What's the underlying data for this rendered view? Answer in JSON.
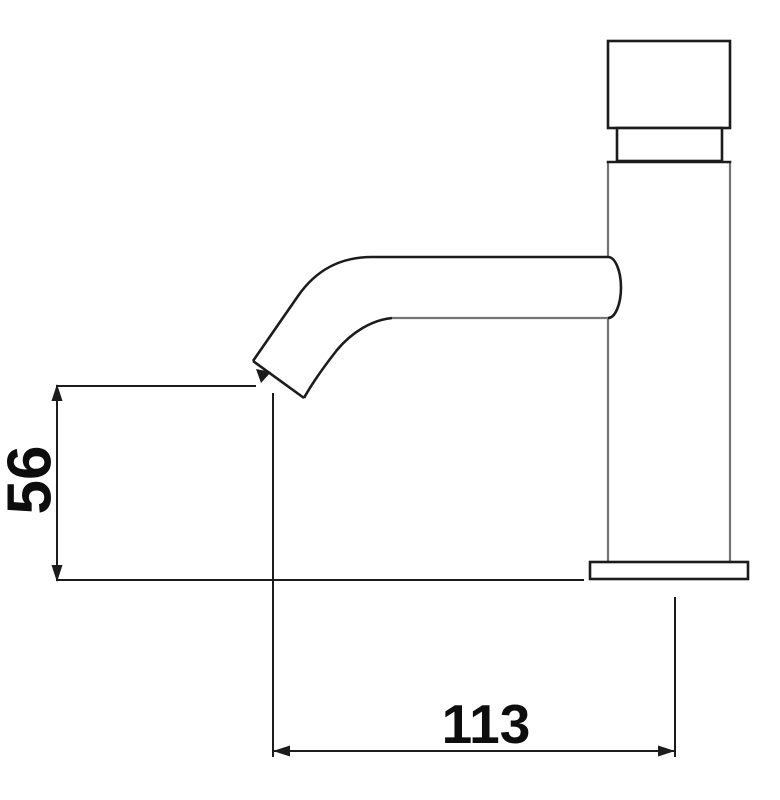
{
  "diagram": {
    "kind": "technical-dimension-drawing",
    "labels": {
      "height_mm": "56",
      "reach_mm": "113"
    },
    "colors": {
      "primary_line": "#1c1c1c",
      "secondary_line": "#757575",
      "dimension_line": "#1c1c1c",
      "text": "#0d0d0d",
      "background": "#ffffff"
    }
  }
}
